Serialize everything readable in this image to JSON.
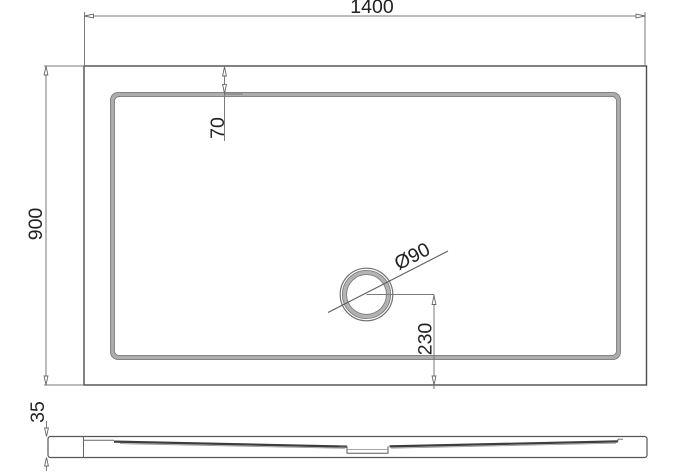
{
  "drawing": {
    "labels": {
      "width": "1400",
      "depth": "900",
      "rim_offset": "70",
      "drain_diameter": "Ø90",
      "drain_to_edge": "230",
      "height": "35"
    },
    "colors": {
      "background": "#ffffff",
      "outline": "#4c4c4c",
      "rim_band": "#ababab",
      "dimension_line": "#7a7a7a",
      "text": "#222222"
    }
  }
}
